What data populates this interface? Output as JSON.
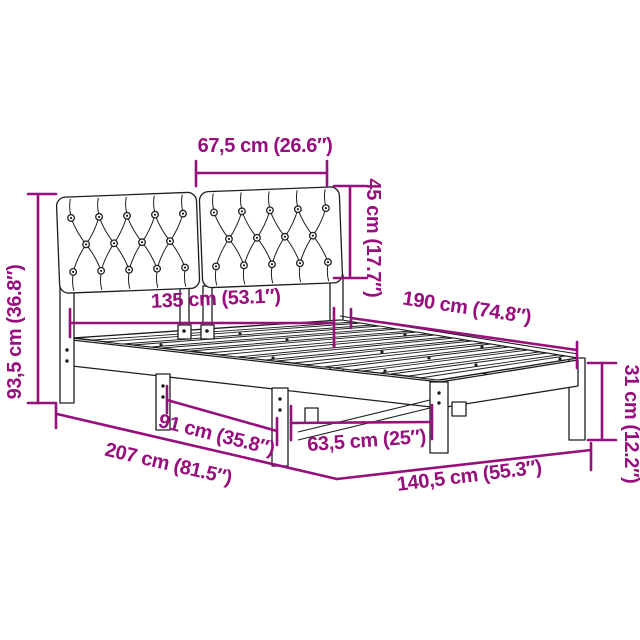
{
  "colors": {
    "dimension": "#970e7d",
    "line": "#1d1d1d",
    "background": "#ffffff"
  },
  "labels": {
    "panel_width": "67,5 cm (26.6″)",
    "headboard_height": "45 cm (17.7″)",
    "total_height": "93,5 cm (36.8″)",
    "slat_width": "135 cm (53.1″)",
    "bed_length": "190 cm (74.8″)",
    "frame_height": "31 cm (12.2″)",
    "leg_gap_head": "91 cm (35.8″)",
    "leg_gap_foot": "63,5 cm (25″)",
    "total_length": "207 cm (81.5″)",
    "total_width": "140,5 cm (55.3″)"
  }
}
